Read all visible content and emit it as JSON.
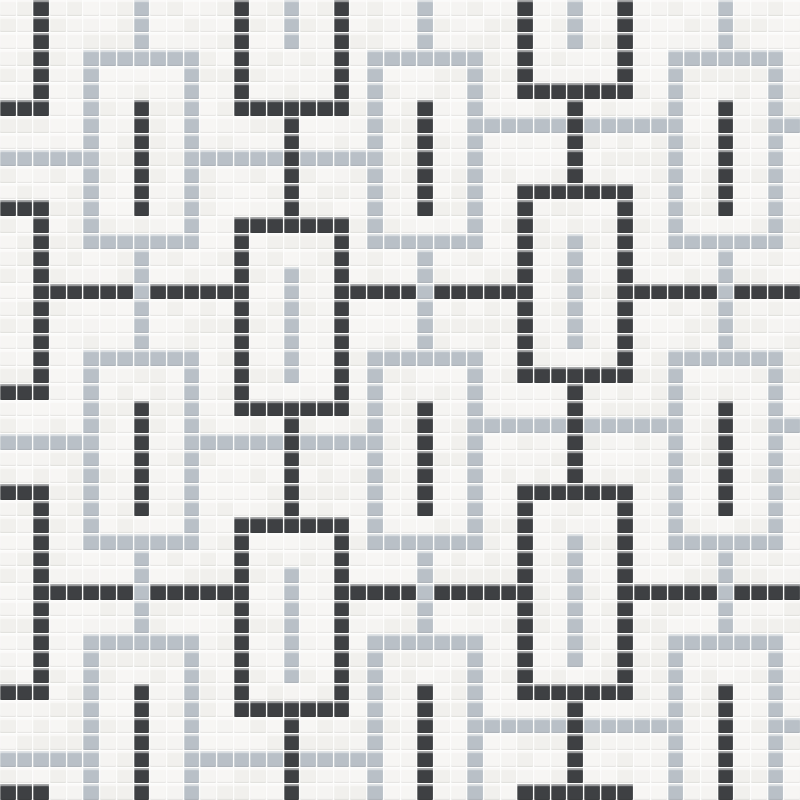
{
  "title": "black white and gray interlocking chains mosaic tile pattern",
  "grid": {
    "cols": 48,
    "rows": 48,
    "canvas_px": 800
  },
  "colors": {
    "white": "#f5f4f2",
    "white_alt": "#f1f0ed",
    "white_alt2": "#f7f6f4",
    "dark": "#3e4043",
    "gray": "#b9c0c7",
    "grout": "#fdfdfc"
  },
  "pattern": {
    "gray_lines": [
      {
        "row": 9,
        "segments": [
          [
            0,
            4
          ],
          [
            12,
            21
          ]
        ]
      },
      {
        "row": 26,
        "segments": [
          [
            0,
            4
          ],
          [
            12,
            21
          ]
        ]
      },
      {
        "row": 45,
        "segments": [
          [
            0,
            4
          ],
          [
            12,
            21
          ]
        ]
      },
      {
        "row": 7,
        "segments": [
          [
            29,
            39
          ],
          [
            47,
            47
          ]
        ]
      },
      {
        "row": 25,
        "segments": [
          [
            29,
            39
          ],
          [
            47,
            47
          ]
        ]
      },
      {
        "row": 43,
        "segments": [
          [
            29,
            39
          ],
          [
            47,
            47
          ]
        ]
      }
    ],
    "dark_lines": [
      {
        "row": 17,
        "segments": [
          [
            3,
            13
          ],
          [
            21,
            30
          ],
          [
            38,
            47
          ]
        ]
      },
      {
        "row": 35,
        "segments": [
          [
            3,
            13
          ],
          [
            21,
            30
          ],
          [
            38,
            47
          ]
        ]
      }
    ],
    "dark_chains": [
      {
        "center": -1,
        "links": [
          {
            "top": -6,
            "bottom": 6
          },
          {
            "top": 12,
            "bottom": 23
          },
          {
            "top": 29,
            "bottom": 41
          },
          {
            "top": 47,
            "bottom": 58
          }
        ],
        "stems": [
          [
            7,
            11
          ],
          [
            24,
            28
          ],
          [
            42,
            46
          ]
        ],
        "bars": []
      },
      {
        "center": 17,
        "links": [
          {
            "top": -6,
            "bottom": 6
          },
          {
            "top": 13,
            "bottom": 24
          },
          {
            "top": 31,
            "bottom": 42
          }
        ],
        "stems": [
          [
            7,
            12
          ],
          [
            25,
            30
          ],
          [
            43,
            47
          ]
        ],
        "bars": [
          [
            0,
            2
          ],
          [
            16,
            22
          ],
          [
            34,
            40
          ]
        ]
      },
      {
        "center": 34,
        "links": [
          {
            "top": -7,
            "bottom": 5
          },
          {
            "top": 11,
            "bottom": 22
          },
          {
            "top": 29,
            "bottom": 41
          },
          {
            "top": 47,
            "bottom": 58
          }
        ],
        "stems": [
          [
            6,
            10
          ],
          [
            23,
            28
          ],
          [
            42,
            46
          ]
        ],
        "bars": [
          [
            0,
            2
          ],
          [
            14,
            20
          ],
          [
            32,
            39
          ]
        ]
      }
    ],
    "gray_chains": [
      {
        "center": 8,
        "links": [
          {
            "top": 3,
            "bottom": 14
          },
          {
            "top": 21,
            "bottom": 32
          },
          {
            "top": 38,
            "bottom": 49
          }
        ],
        "stems": [
          [
            0,
            2
          ],
          [
            15,
            20
          ],
          [
            33,
            37
          ]
        ],
        "bars": [
          [
            6,
            12
          ],
          [
            24,
            30
          ],
          [
            41,
            47
          ]
        ]
      },
      {
        "center": 25,
        "links": [
          {
            "top": 3,
            "bottom": 14
          },
          {
            "top": 21,
            "bottom": 32
          },
          {
            "top": 38,
            "bottom": 49
          }
        ],
        "stems": [
          [
            0,
            2
          ],
          [
            15,
            20
          ],
          [
            33,
            37
          ]
        ],
        "bars": [
          [
            6,
            12
          ],
          [
            24,
            30
          ],
          [
            41,
            47
          ]
        ]
      },
      {
        "center": 43,
        "links": [
          {
            "top": 3,
            "bottom": 14
          },
          {
            "top": 21,
            "bottom": 32
          },
          {
            "top": 38,
            "bottom": 49
          }
        ],
        "stems": [
          [
            0,
            2
          ],
          [
            15,
            20
          ],
          [
            33,
            37
          ]
        ],
        "bars": [
          [
            6,
            12
          ],
          [
            24,
            30
          ],
          [
            41,
            47
          ]
        ]
      }
    ],
    "link_width": 7,
    "tile_counts": {
      "total": 2304
    }
  }
}
